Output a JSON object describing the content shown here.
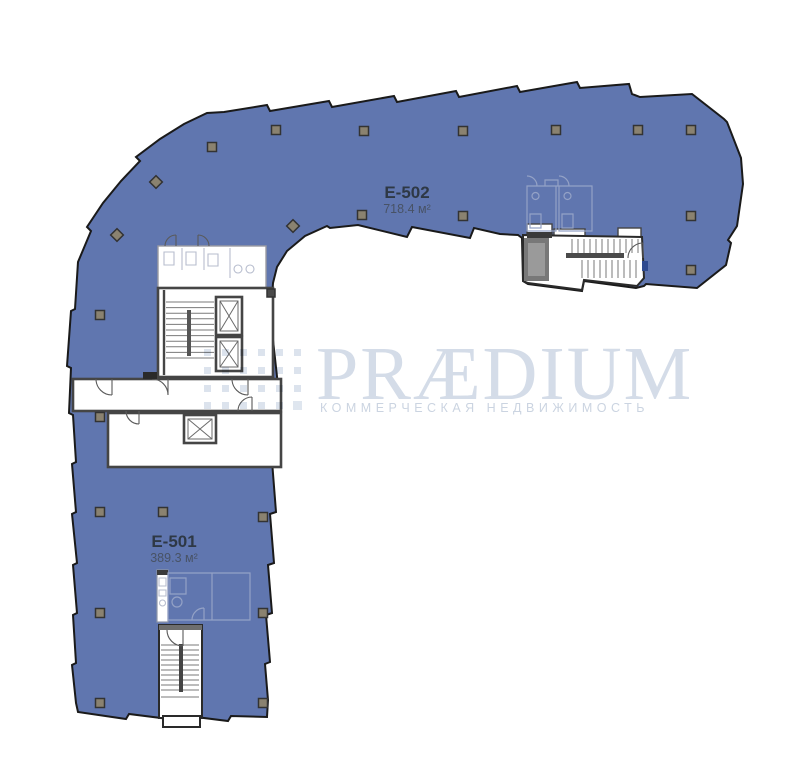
{
  "plan": {
    "type": "floor-plan",
    "units": [
      {
        "id": "E-502",
        "area": "718.4 м²"
      },
      {
        "id": "E-501",
        "area": "389.3 м²"
      }
    ]
  },
  "logo": {
    "name": "PRÆDIUM",
    "tagline": "КОММЕРЧЕСКАЯ НЕДВИЖИМОСТЬ",
    "icon": "praedium-blocks-icon"
  },
  "colors": {
    "floor_fill": "#6076AF",
    "wall_outline": "#1a1a1a",
    "core_wall": "#454545",
    "unit_label": "#2E3845",
    "unit_area": "#46505F",
    "logo_text": "#D4DCE8",
    "logo_tagline": "#CBD4E1",
    "logo_block": "#DCE3ED",
    "column_fill": "#8A8270",
    "faint_line": "#94A2C6"
  }
}
